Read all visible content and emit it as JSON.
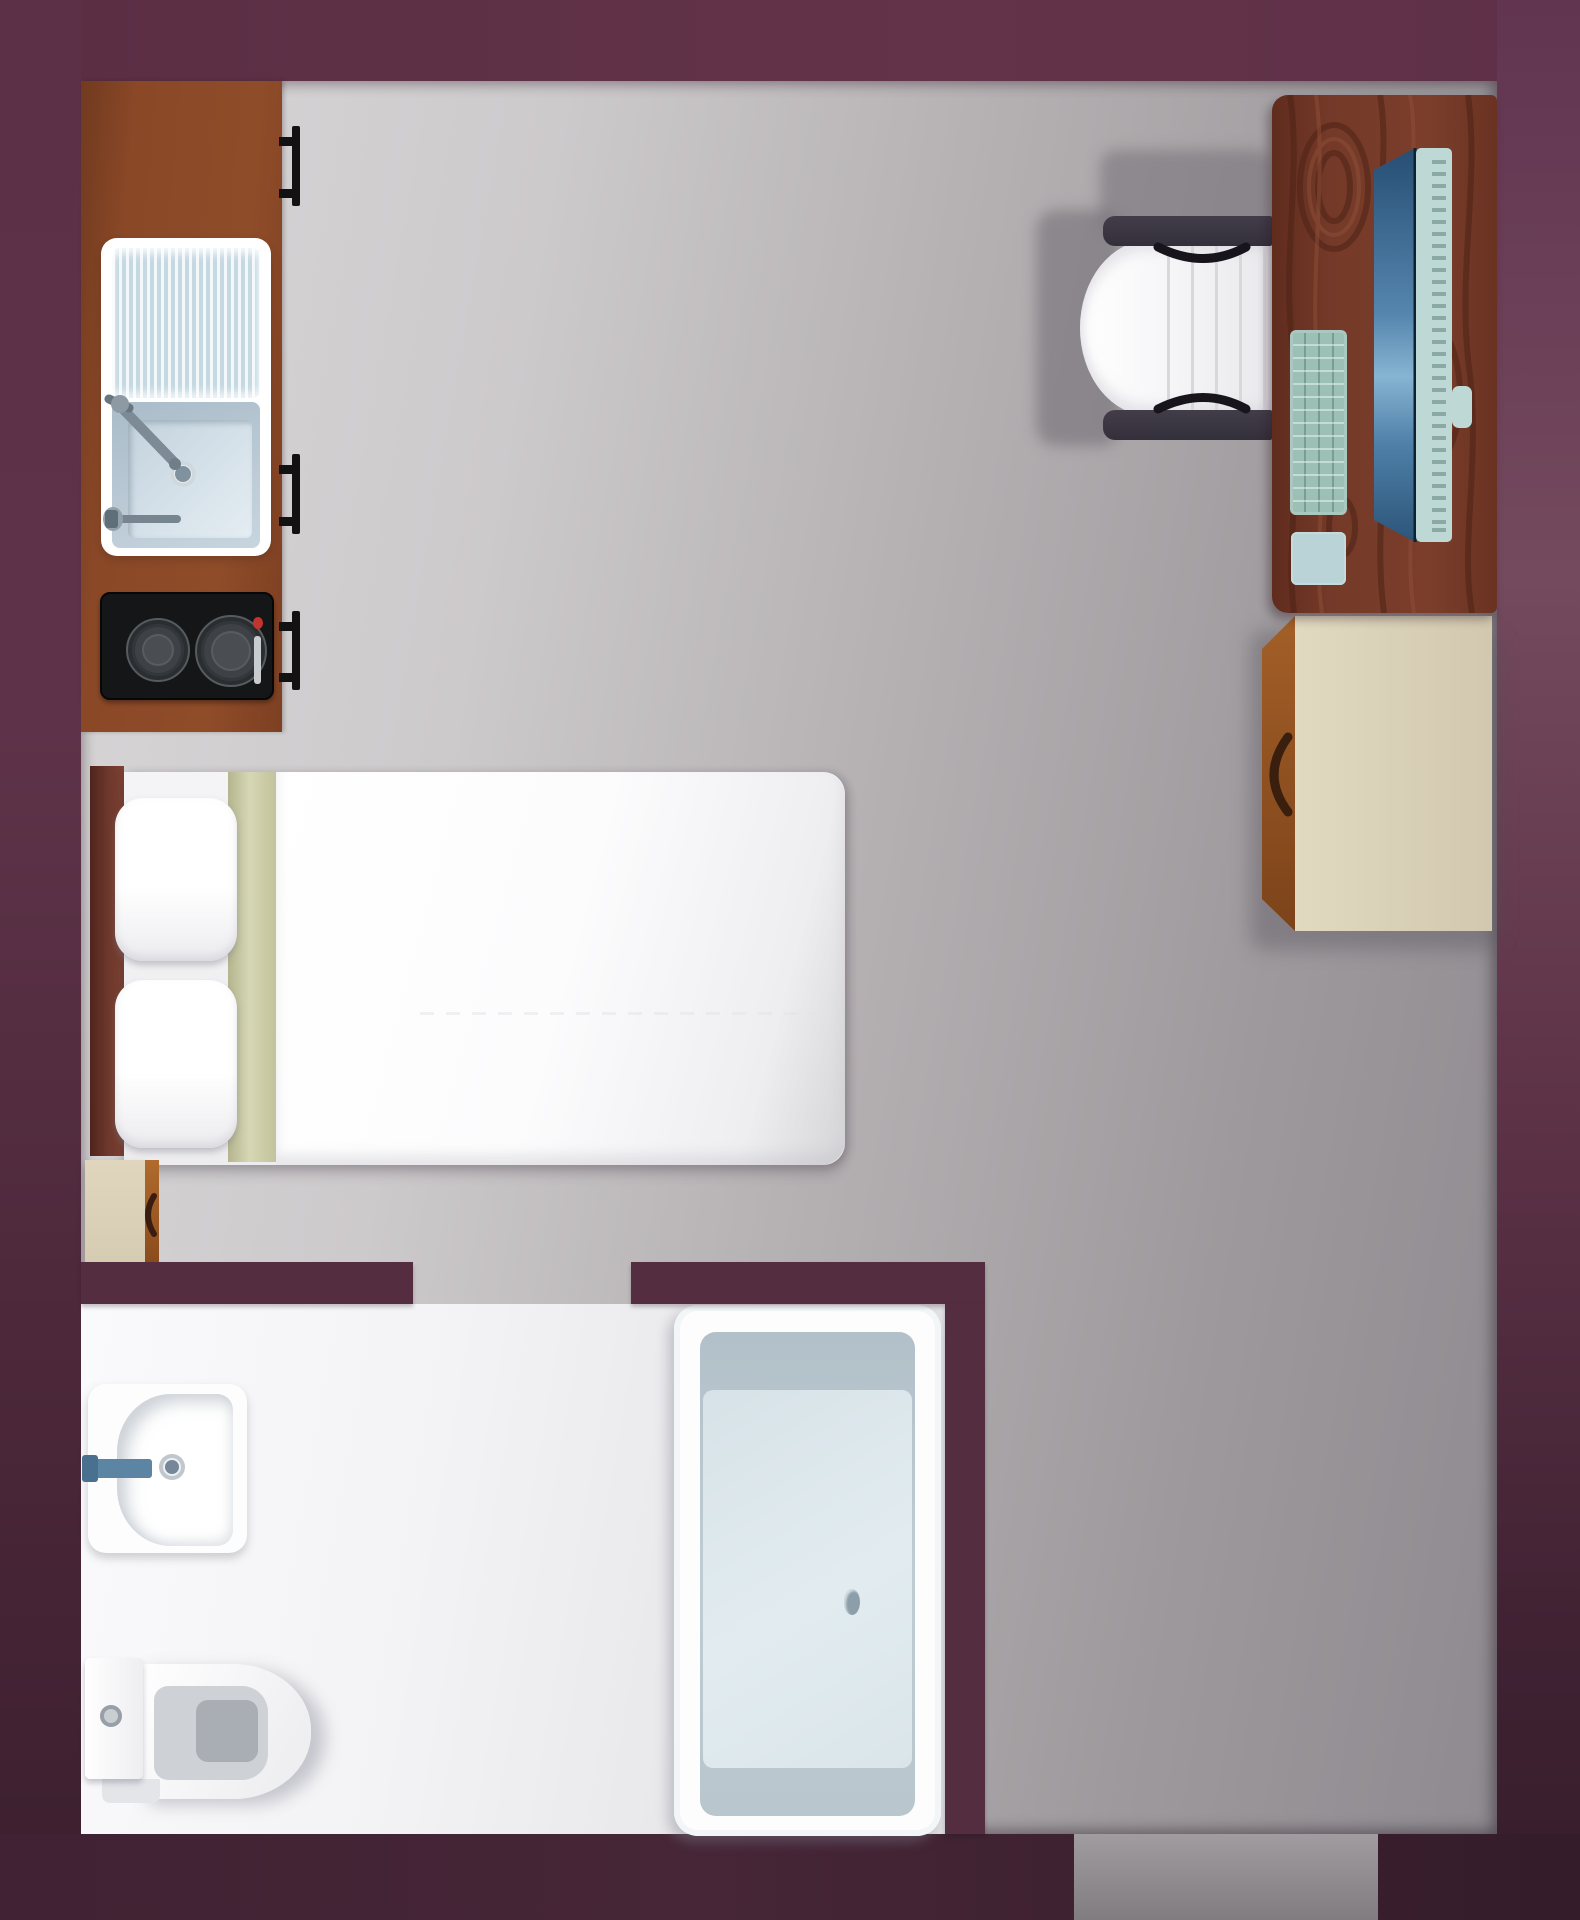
{
  "plan": {
    "title": "Studio apartment floor plan",
    "view": "top-down",
    "size_px": {
      "width": 1580,
      "height": 1920
    }
  },
  "palette": {
    "wall": "#5c3046",
    "wall_dark": "#3a1f2f",
    "interior_wall": "#542d41",
    "floor_light": "#d8d6d7",
    "floor_dark": "#8e8a90",
    "bathroom_floor": "#f5f5f7",
    "counter_wood": "#8a4827",
    "desk_wood": "#6f3524",
    "dresser_tan": "#d9d0b8",
    "linen_white": "#ffffff",
    "blanket_sage": "#cfd0ab",
    "fixture_blue_gray": "#cfdfe7",
    "stove_black": "#141617",
    "stove_indicator_red": "#c3342f",
    "monitor_screen_blue": "#5585ad",
    "monitor_shell_teal": "#bed9d5",
    "faucet_steel_blue": "#5c85a4"
  },
  "zones": {
    "kitchen": {
      "label": "Kitchenette"
    },
    "sleeping": {
      "label": "Sleeping area"
    },
    "workspace": {
      "label": "Workspace"
    },
    "bathroom": {
      "label": "Bathroom"
    },
    "entry": {
      "label": "Entry doorway"
    }
  },
  "openings": {
    "bathroom_doorway": {
      "label": "Bathroom doorway"
    },
    "entry_doorway": {
      "label": "Apartment entry doorway"
    }
  },
  "furniture": {
    "kitchen_counter": {
      "label": "Kitchen counter"
    },
    "cabinet_handles": {
      "label": "Cabinet door handle",
      "count": 3
    },
    "kitchen_sink": {
      "label": "Kitchen sink with drainboard"
    },
    "kitchen_faucet": {
      "label": "Kitchen faucet"
    },
    "stove": {
      "label": "Two-burner cooktop",
      "burners": 2,
      "indicator": "red power light"
    },
    "bed": {
      "label": "Double bed"
    },
    "headboard": {
      "label": "Bed headboard"
    },
    "pillows": {
      "label": "Pillow",
      "count": 2
    },
    "blanket_fold": {
      "label": "Folded blanket band"
    },
    "duvet": {
      "label": "White duvet"
    },
    "nightstand": {
      "label": "Bedside cabinet"
    },
    "desk": {
      "label": "Wooden desk"
    },
    "monitor": {
      "label": "Computer monitor"
    },
    "keyboard": {
      "label": "Keyboard"
    },
    "mouse_pad": {
      "label": "Mouse pad"
    },
    "office_chair": {
      "label": "Office chair"
    },
    "dresser": {
      "label": "Dresser cabinet"
    },
    "bathroom_sink": {
      "label": "Bathroom washbasin"
    },
    "bathroom_faucet": {
      "label": "Basin faucet"
    },
    "toilet": {
      "label": "Toilet with tank"
    },
    "bathtub": {
      "label": "Bathtub"
    },
    "bathtub_drain": {
      "label": "Bathtub drain"
    }
  }
}
